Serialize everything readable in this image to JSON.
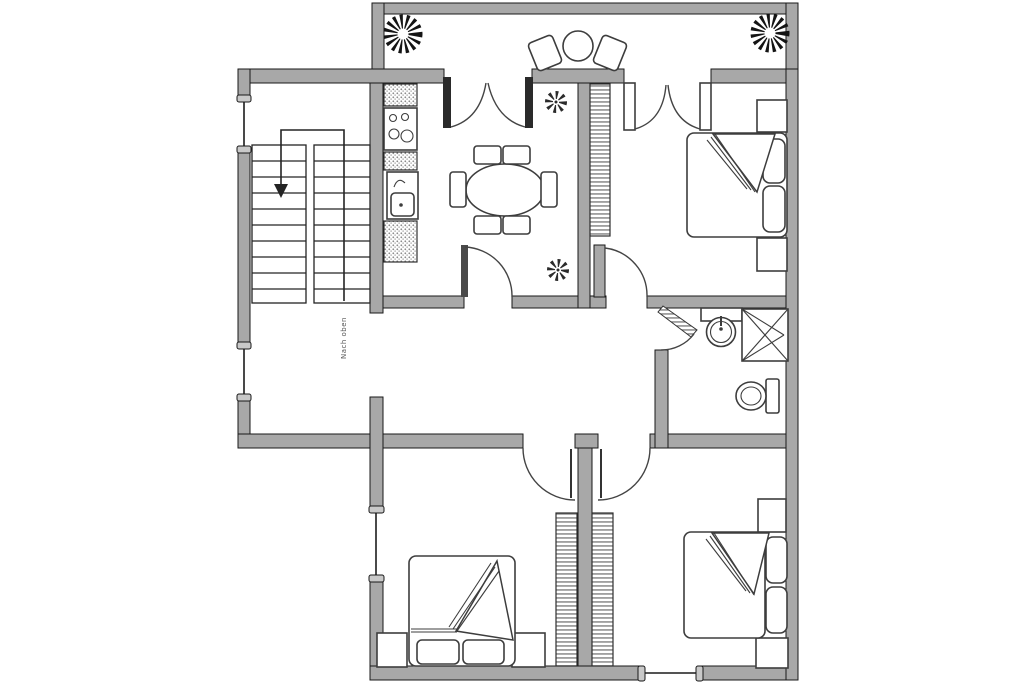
{
  "page": {
    "background": "#ffffff"
  },
  "palette": {
    "wall_fill": "#a8a8a8",
    "wall_stroke": "#191919",
    "furniture_stroke": "#3d3d3d",
    "symbol_color": "#141414"
  },
  "plan": {
    "type": "apartment-floor-plan",
    "stairs_label": "Nach oben",
    "window_count": 4,
    "door_count": 7,
    "rooms": [
      {
        "name": "balcony",
        "fixtures": [
          "potted-plant",
          "potted-plant",
          "bistro-table",
          "chair",
          "chair"
        ]
      },
      {
        "name": "stair-hall",
        "fixtures": [
          "u-shaped-staircase",
          "direction-arrow"
        ]
      },
      {
        "name": "kitchen-dining",
        "fixtures": [
          "countertop",
          "cooktop-4-burners",
          "kitchen-sink",
          "dining-table",
          "chair",
          "chair",
          "chair",
          "chair",
          "chair",
          "chair",
          "plant",
          "plant",
          "french-double-door"
        ]
      },
      {
        "name": "bedroom-top-right",
        "fixtures": [
          "double-bed",
          "pillow",
          "pillow",
          "nightstand",
          "nightstand",
          "wardrobe",
          "french-double-door"
        ]
      },
      {
        "name": "bathroom",
        "fixtures": [
          "washbasin",
          "shower",
          "toilet"
        ]
      },
      {
        "name": "bedroom-bottom-left",
        "fixtures": [
          "double-bed",
          "pillow",
          "pillow",
          "nightstand",
          "nightstand",
          "wardrobe"
        ]
      },
      {
        "name": "bedroom-bottom-right",
        "fixtures": [
          "double-bed",
          "pillow",
          "pillow",
          "nightstand",
          "nightstand",
          "wardrobe"
        ]
      }
    ]
  }
}
